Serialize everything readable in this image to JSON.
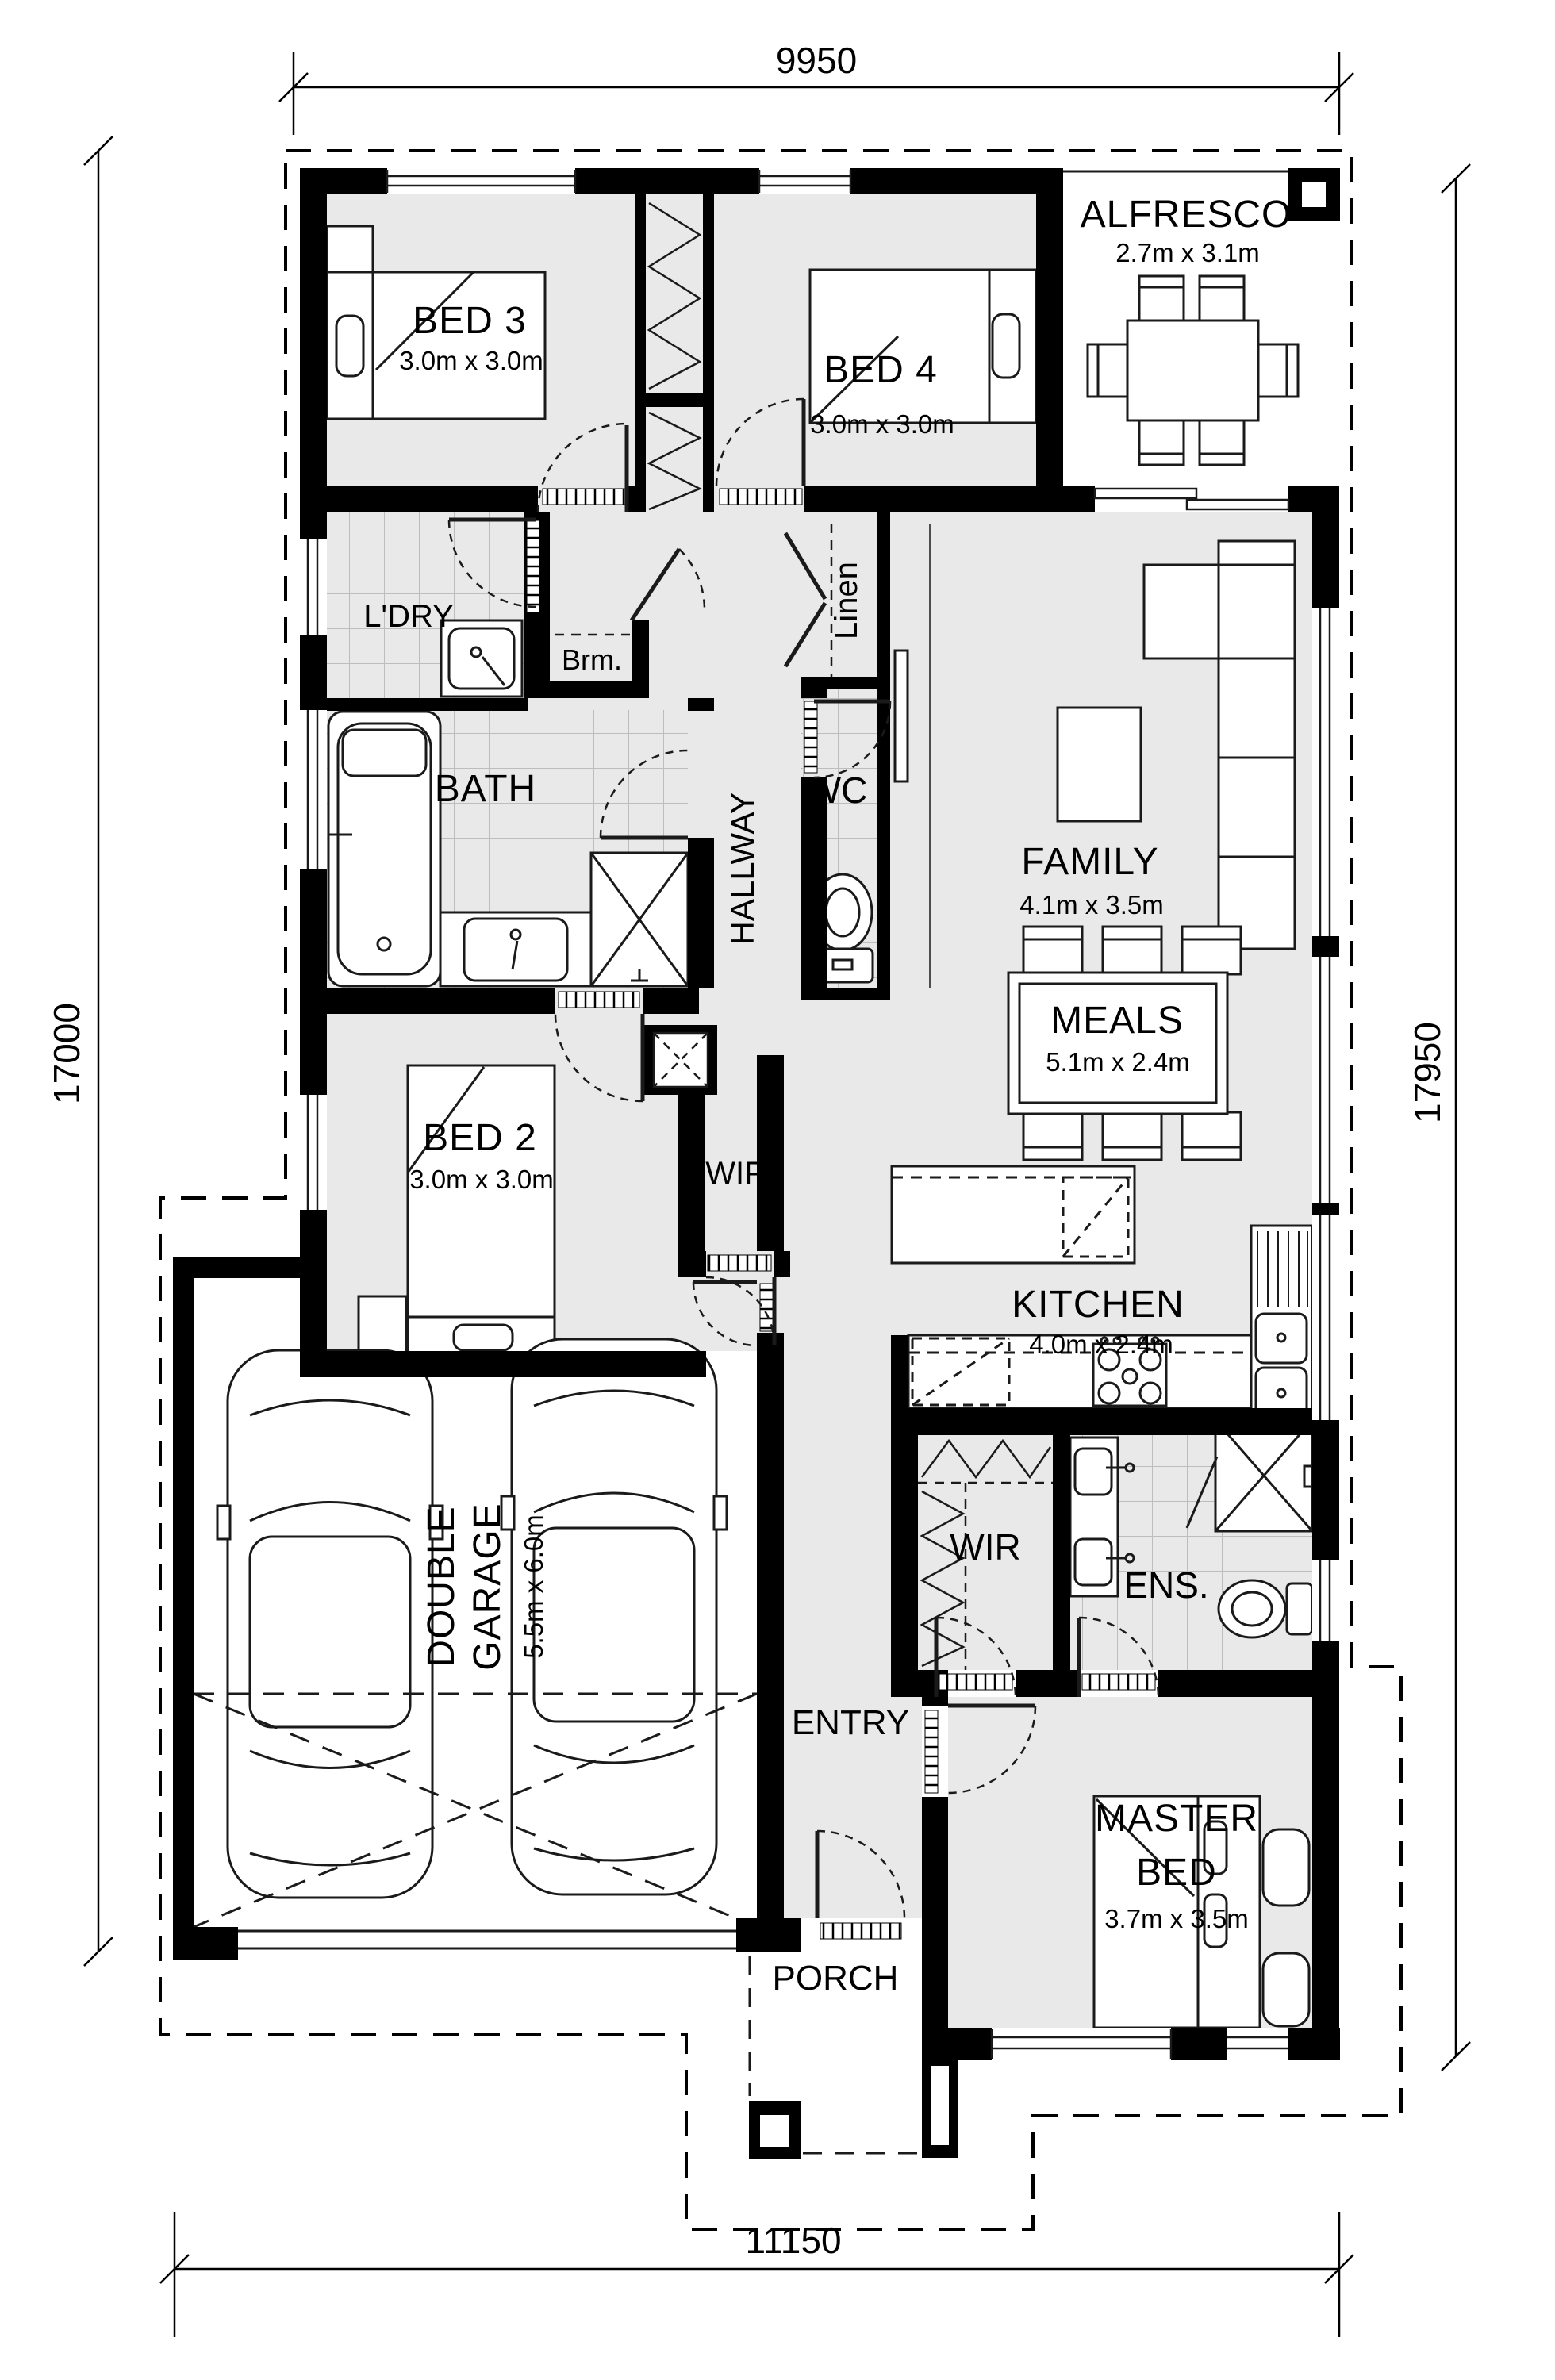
{
  "plan": {
    "dims": {
      "top": "9950",
      "bottom": "11150",
      "left": "17000",
      "right": "17950"
    },
    "rooms": {
      "bed3": {
        "name": "BED 3",
        "size": "3.0m x 3.0m"
      },
      "bed4": {
        "name": "BED 4",
        "size": "3.0m x 3.0m"
      },
      "alfresco": {
        "name": "ALFRESCO",
        "size": "2.7m x 3.1m"
      },
      "ldry": {
        "name": "L'DRY"
      },
      "brm": {
        "name": "Brm."
      },
      "linen": {
        "name": "Linen"
      },
      "bath": {
        "name": "BATH"
      },
      "hallway": {
        "name": "HALLWAY"
      },
      "wc": {
        "name": "WC"
      },
      "family": {
        "name": "FAMILY",
        "size": "4.1m x 3.5m"
      },
      "meals": {
        "name": "MEALS",
        "size": "5.1m x 2.4m"
      },
      "bed2": {
        "name": "BED 2",
        "size": "3.0m x 3.0m"
      },
      "wip": {
        "name": "WIP"
      },
      "kitchen": {
        "name": "KITCHEN",
        "size": "4.0m x 2.4m"
      },
      "garage": {
        "line1": "DOUBLE",
        "line2": "GARAGE",
        "size": "5.5m x 6.0m"
      },
      "wir": {
        "name": "WIR"
      },
      "ens": {
        "name": "ENS."
      },
      "entry": {
        "name": "ENTRY"
      },
      "master": {
        "line1": "MASTER",
        "line2": "BED",
        "size": "3.7m x 3.5m"
      },
      "porch": {
        "name": "PORCH"
      }
    },
    "colors": {
      "wall": "#000000",
      "floor": "#e9e9e9",
      "paper": "#ffffff"
    }
  }
}
